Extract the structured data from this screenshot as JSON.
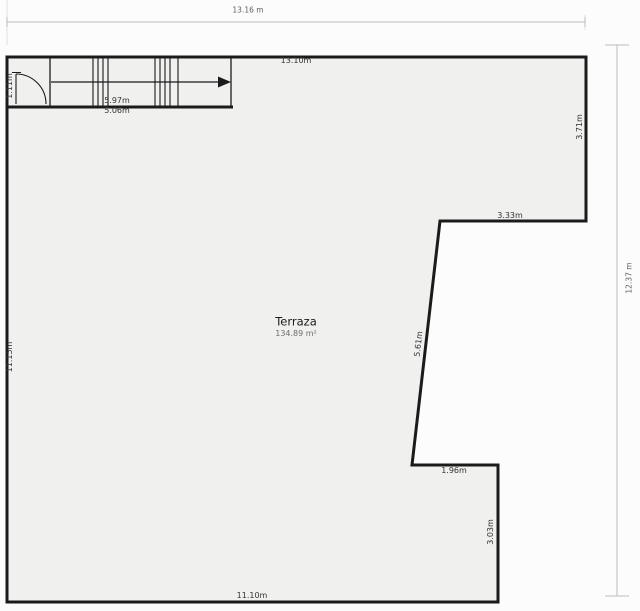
{
  "room": {
    "name": "Terraza",
    "area": "134.89 m²"
  },
  "dimensions": {
    "overall_width": "13.16 m",
    "overall_height": "12.37 m",
    "top_wall_inner": "13.10m",
    "left_wall": "11.15m",
    "bottom_wall": "11.10m",
    "right_wall_upper": "3.71m",
    "notch_top": "3.33m",
    "notch_slanted": "5.61m",
    "notch_bottom": "1.96m",
    "right_wall_lower": "3.03m",
    "door_opening": "1.11m",
    "stair_upper": "5.97m",
    "stair_lower": "5.06m"
  },
  "colors": {
    "wall": "#1b1b1b",
    "floor_fill": "#f0f0ef",
    "dimension_line": "#bdbdbd",
    "extension_line": "#d9d9d9",
    "label_text": "#333333",
    "muted_text": "#5f5f5f",
    "background": "#fcfcfc"
  }
}
